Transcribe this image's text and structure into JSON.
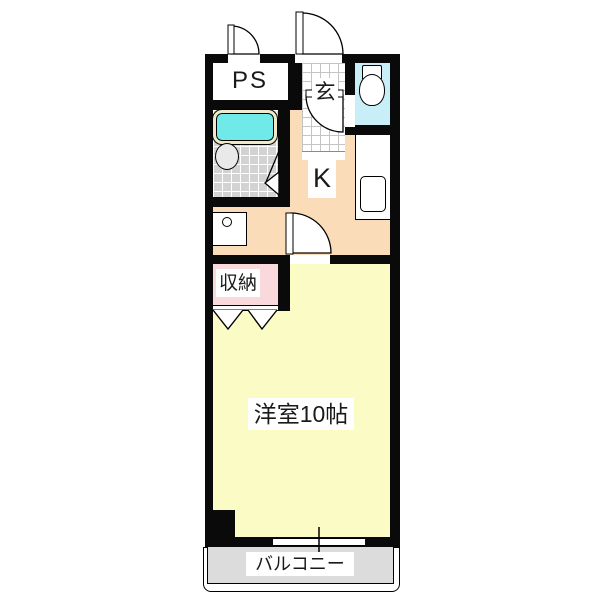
{
  "floorplan": {
    "type": "apartment-floor-plan",
    "rooms": [
      {
        "id": "ps",
        "label": "PS"
      },
      {
        "id": "entrance",
        "label": "玄"
      },
      {
        "id": "kitchen",
        "label": "K"
      },
      {
        "id": "closet",
        "label": "収納"
      },
      {
        "id": "western_room",
        "label": "洋室10帖"
      },
      {
        "id": "balcony",
        "label": "バルコニー"
      }
    ],
    "colors": {
      "wall": "#0a0a0a",
      "kitchen_floor": "#fbdcb9",
      "western_room_floor": "#fbfbc6",
      "closet_floor": "#f9d9db",
      "toilet_floor": "#c8eff7",
      "bathtub_water": "#70e9e9",
      "bathtub_rim": "#efe8c9",
      "bathroom_tile": "#d3d3d3",
      "balcony_floor": "#dcdcdc"
    }
  }
}
